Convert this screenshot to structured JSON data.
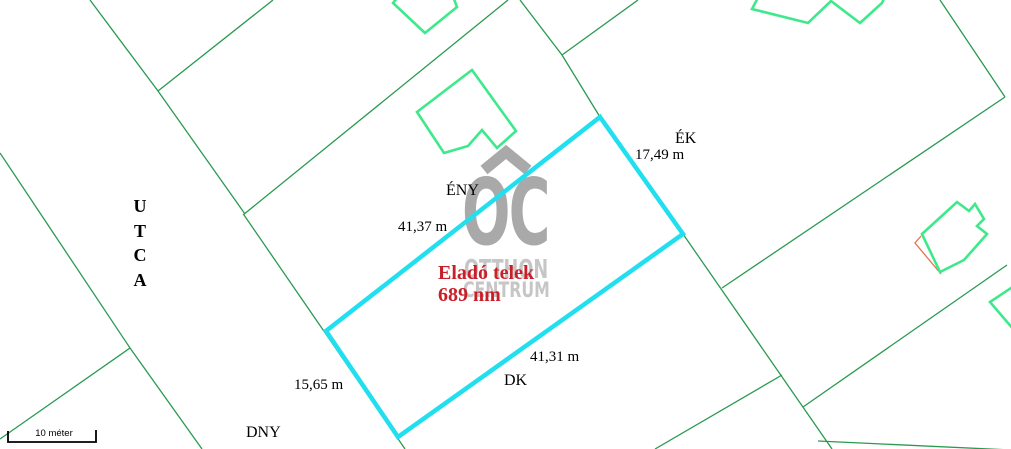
{
  "colors": {
    "background": "#ffffff",
    "parcel_line": "#2a9a50",
    "building_outline": "#3ee98b",
    "plot_outline": "#22dff0",
    "highlight_outline": "#e2744b",
    "watermark_logo": "#a9a9a9",
    "watermark_text": "#c6c6c6",
    "label_text": "#000000",
    "plot_label_text": "#c91f28",
    "scale_bar": "#000000"
  },
  "street": {
    "label": "UTCA"
  },
  "plot": {
    "title": "Eladó telek",
    "area": "689 nm",
    "sides": [
      {
        "direction": "ÉNY",
        "length": "41,37 m"
      },
      {
        "direction": "ÉK",
        "length": "17,49 m"
      },
      {
        "direction": "DK",
        "length": "41,31 m"
      },
      {
        "direction": "DNY",
        "length": "15,65 m"
      }
    ]
  },
  "watermark": {
    "logo": "OC",
    "line1": "OTTHON",
    "line2": "CENTRUM"
  },
  "scale_bar": {
    "label": "10 méter"
  }
}
